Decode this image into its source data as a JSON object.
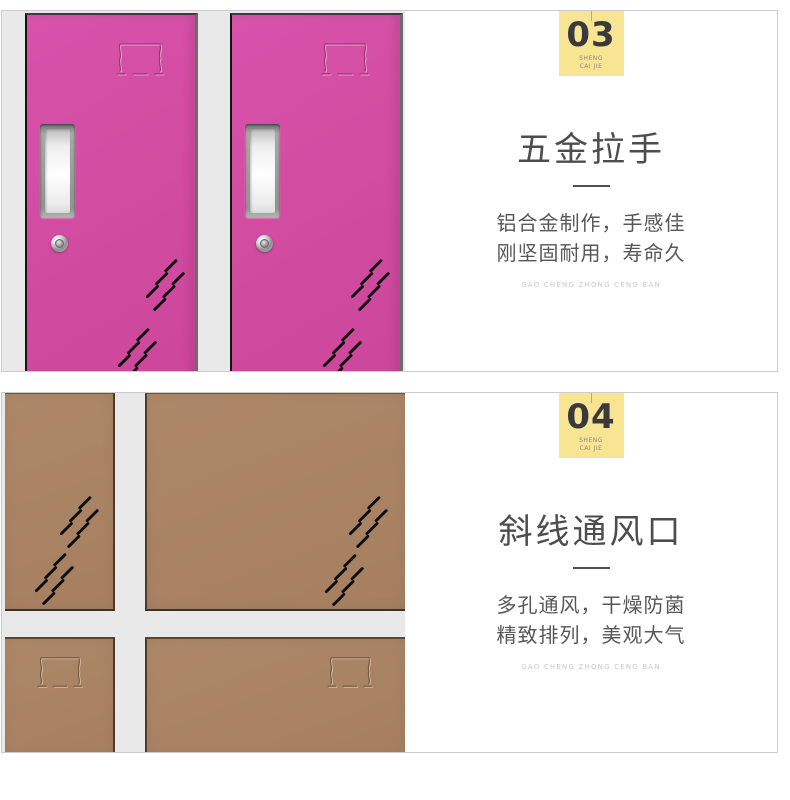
{
  "page": {
    "background": "#ffffff",
    "card_border_color": "#cccccc",
    "badge_background": "#f8e593"
  },
  "sections": [
    {
      "name": "hardware-handle-feature",
      "badge": {
        "number": "03",
        "brand_line1": "SHENG",
        "brand_line2": "CAI JIE"
      },
      "title": "五金拉手",
      "desc_lines": [
        "铝合金制作，手感佳",
        "刚坚固耐用，寿命久"
      ],
      "caption": "GAO CHENG ZHONG CENG BAN",
      "image": {
        "subject": "two pink locker doors with recessed aluminum handles, cam locks, embossed label holders and diagonal vent slots",
        "door_color": "#d04a9f",
        "background_color": "#e9e9e9",
        "icons": [
          "label-emboss-icon",
          "recessed-handle",
          "cam-lock-icon",
          "diagonal-vents-icon"
        ]
      }
    },
    {
      "name": "diagonal-vent-feature",
      "badge": {
        "number": "04",
        "brand_line1": "SHENG",
        "brand_line2": "CAI JIE"
      },
      "title": "斜线通风口",
      "desc_lines": [
        "多孔通风，干燥防菌",
        "精致排列，美观大气"
      ],
      "caption": "GAO CHENG ZHONG CENG BAN",
      "image": {
        "subject": "2x2 grid of brown locker doors with diagonal vent slots and embossed label holders, light gray frame",
        "door_color": "#a57f60",
        "frame_color": "#e9e9e9",
        "icons": [
          "diagonal-vents-icon",
          "label-emboss-icon"
        ]
      }
    }
  ]
}
